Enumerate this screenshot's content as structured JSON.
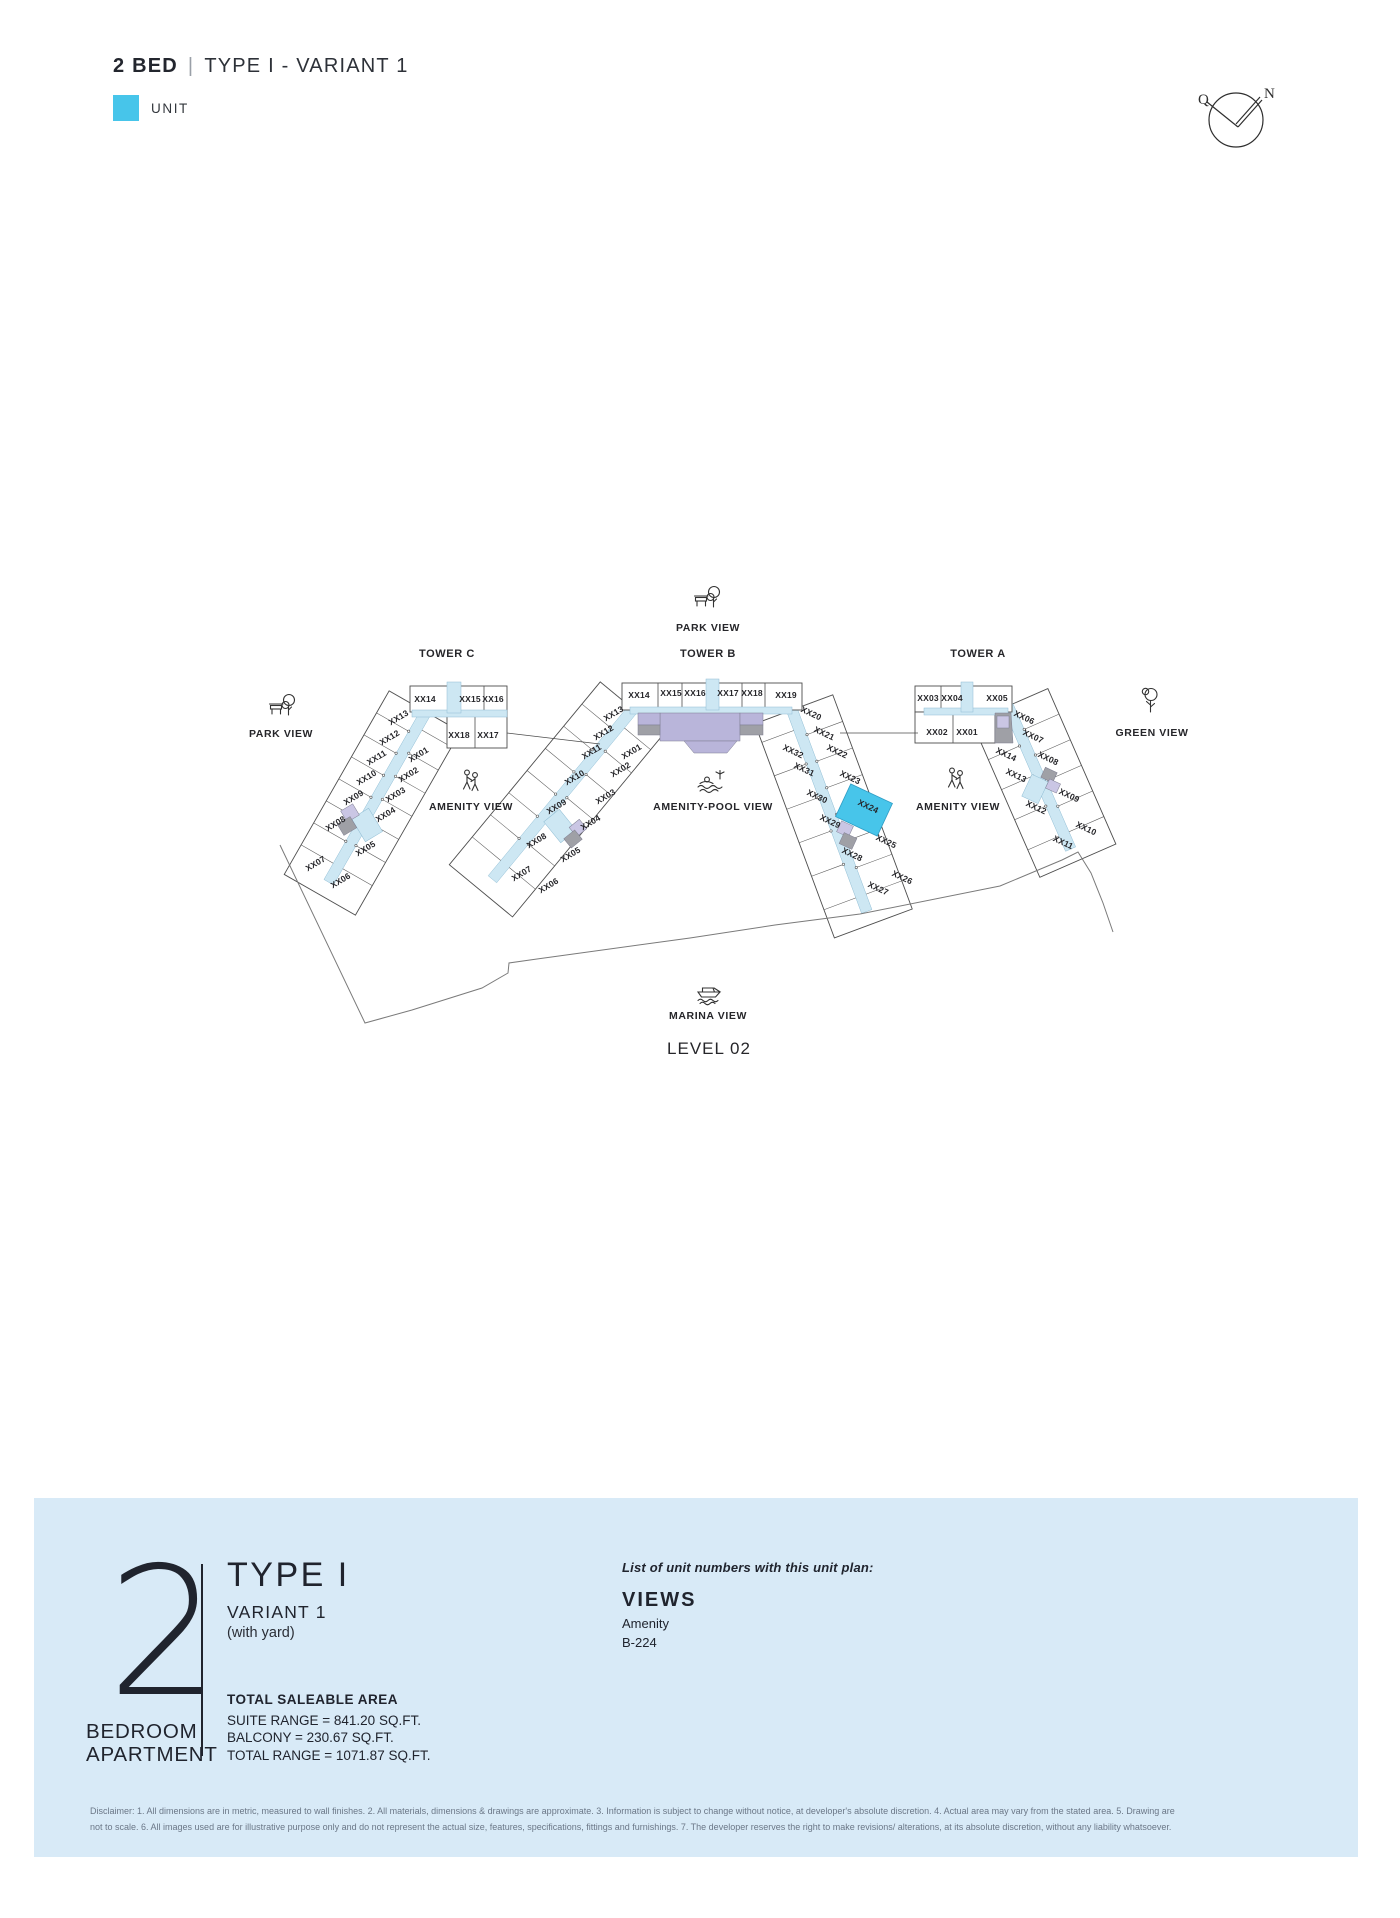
{
  "colors": {
    "accent_cyan": "#47C5EA",
    "panel_bg": "#D8EAF7",
    "corridor": "#cde7f3",
    "purple": "#b9b5da",
    "lavender": "#cac6e4",
    "gray": "#9fa0a6",
    "ink": "#20242e",
    "outline": "#4d4d4d",
    "boundary": "#7a7a7a"
  },
  "header": {
    "title_bold": "2 BED",
    "separator": "|",
    "title_rest": "TYPE I - VARIANT 1",
    "legend_label": "UNIT"
  },
  "compass": {
    "left_letter": "Q",
    "right_letter": "N"
  },
  "plan": {
    "level_label": "LEVEL 02",
    "level_pos": {
      "x": 709,
      "y": 1054
    },
    "towers": [
      {
        "name": "TOWER C",
        "x": 447,
        "y": 657
      },
      {
        "name": "TOWER B",
        "x": 708,
        "y": 657
      },
      {
        "name": "TOWER A",
        "x": 978,
        "y": 657
      }
    ],
    "views": [
      {
        "name": "park-view-top",
        "label": "PARK VIEW",
        "icon": "park",
        "lx": 708,
        "ly": 631,
        "ix": 708,
        "iy": 598
      },
      {
        "name": "park-view-left",
        "label": "PARK VIEW",
        "icon": "park",
        "lx": 281,
        "ly": 737,
        "ix": 283,
        "iy": 706
      },
      {
        "name": "amenity-view-left",
        "label": "AMENITY VIEW",
        "icon": "people",
        "lx": 471,
        "ly": 810,
        "ix": 471,
        "iy": 781
      },
      {
        "name": "amenity-pool-view",
        "label": "AMENITY-POOL VIEW",
        "icon": "pool",
        "lx": 713,
        "ly": 810,
        "ix": 711,
        "iy": 783
      },
      {
        "name": "amenity-view-right",
        "label": "AMENITY VIEW",
        "icon": "people",
        "lx": 958,
        "ly": 810,
        "ix": 956,
        "iy": 779
      },
      {
        "name": "green-view",
        "label": "GREEN VIEW",
        "icon": "tree",
        "lx": 1152,
        "ly": 736,
        "ix": 1150,
        "iy": 700
      },
      {
        "name": "marina-view",
        "label": "MARINA VIEW",
        "icon": "boat",
        "lx": 708,
        "ly": 1019,
        "ix": 708,
        "iy": 991
      }
    ],
    "wings": [
      {
        "id": "tower-c-wing",
        "p1": [
          426,
          712
        ],
        "p2": [
          338,
          866
        ],
        "cap": 34,
        "outer_side": "right",
        "outer_w": 37,
        "inner_w": 34,
        "n_outer": 7,
        "n_inner": 6,
        "inner_t0": 0.1,
        "ch": 5.5
      },
      {
        "id": "tower-b-left-wing",
        "p1": [
          633,
          709
        ],
        "p2": [
          505,
          864
        ],
        "cap": 36,
        "outer_side": "right",
        "outer_w": 37,
        "inner_w": 34,
        "n_outer": 7,
        "n_inner": 6,
        "inner_t0": 0.1,
        "ch": 5.5
      },
      {
        "id": "tower-b-right-wing",
        "p1": [
          792,
          710
        ],
        "p2": [
          861,
          896
        ],
        "cap": 30,
        "outer_side": "left",
        "outer_w": 38,
        "inner_w": 34,
        "n_outer": 7,
        "n_inner": 5,
        "inner_t0": 0.1,
        "ch": 5.5
      },
      {
        "id": "tower-a-wing",
        "p1": [
          1008,
          706
        ],
        "p2": [
          1064,
          834
        ],
        "cap": 30,
        "outer_side": "left",
        "outer_w": 38,
        "inner_w": 34,
        "n_outer": 5,
        "n_inner": 4,
        "inner_t0": 0.06,
        "ch": 5.5
      }
    ],
    "shapes": [
      {
        "k": "rect",
        "x": 410,
        "y": 686,
        "w": 97,
        "h": 26,
        "f": "#ffffff",
        "s": 1
      },
      {
        "k": "rect",
        "x": 447,
        "y": 712,
        "w": 60,
        "h": 36,
        "f": "#ffffff",
        "s": 1
      },
      {
        "k": "line",
        "x1": 484,
        "y1": 686,
        "x2": 484,
        "y2": 712
      },
      {
        "k": "line",
        "x1": 475,
        "y1": 712,
        "x2": 475,
        "y2": 748
      },
      {
        "k": "rect",
        "x": 412,
        "y": 710,
        "w": 95,
        "h": 7,
        "f": "corridor"
      },
      {
        "k": "rect",
        "x": 447,
        "y": 682,
        "w": 14,
        "h": 31,
        "f": "corridor"
      },
      {
        "k": "rect",
        "x": 622,
        "y": 683,
        "w": 180,
        "h": 27,
        "f": "#ffffff",
        "s": 1
      },
      {
        "k": "line",
        "x1": 658,
        "y1": 683,
        "x2": 658,
        "y2": 710
      },
      {
        "k": "line",
        "x1": 682,
        "y1": 683,
        "x2": 682,
        "y2": 710
      },
      {
        "k": "line",
        "x1": 742,
        "y1": 683,
        "x2": 742,
        "y2": 710
      },
      {
        "k": "line",
        "x1": 765,
        "y1": 683,
        "x2": 765,
        "y2": 710
      },
      {
        "k": "rect",
        "x": 630,
        "y": 707,
        "w": 162,
        "h": 7,
        "f": "corridor"
      },
      {
        "k": "rect",
        "x": 706,
        "y": 679,
        "w": 13,
        "h": 31,
        "f": "corridor"
      },
      {
        "k": "rect",
        "x": 660,
        "y": 713,
        "w": 80,
        "h": 28,
        "f": "purple"
      },
      {
        "k": "poly",
        "pts": "684,741 737,741 727,753 694,753",
        "f": "purple"
      },
      {
        "k": "rect",
        "x": 638,
        "y": 713,
        "w": 22,
        "h": 12,
        "f": "purple"
      },
      {
        "k": "rect",
        "x": 638,
        "y": 725,
        "w": 22,
        "h": 10,
        "f": "gray"
      },
      {
        "k": "rect",
        "x": 740,
        "y": 713,
        "w": 23,
        "h": 12,
        "f": "purple"
      },
      {
        "k": "rect",
        "x": 740,
        "y": 725,
        "w": 23,
        "h": 10,
        "f": "gray"
      },
      {
        "k": "rect",
        "x": 915,
        "y": 686,
        "w": 97,
        "h": 26,
        "f": "#ffffff",
        "s": 1
      },
      {
        "k": "rect",
        "x": 915,
        "y": 712,
        "w": 80,
        "h": 31,
        "f": "#ffffff",
        "s": 1
      },
      {
        "k": "line",
        "x1": 941,
        "y1": 686,
        "x2": 941,
        "y2": 712
      },
      {
        "k": "line",
        "x1": 953,
        "y1": 712,
        "x2": 953,
        "y2": 743
      },
      {
        "k": "rect",
        "x": 924,
        "y": 708,
        "w": 84,
        "h": 7,
        "f": "corridor"
      },
      {
        "k": "rect",
        "x": 961,
        "y": 682,
        "w": 12,
        "h": 30,
        "f": "corridor"
      },
      {
        "k": "poly",
        "pts": "995,713 1011,713 1013,743 995,743",
        "f": "gray"
      },
      {
        "k": "rect",
        "x": 997,
        "y": 716,
        "w": 12,
        "h": 12,
        "f": "lav"
      },
      {
        "k": "line",
        "x1": 507,
        "y1": 733,
        "x2": 600,
        "y2": 744
      },
      {
        "k": "line",
        "x1": 840,
        "y1": 733,
        "x2": 918,
        "y2": 733
      },
      {
        "k": "rrect",
        "cx": 367,
        "cy": 825,
        "w": 20,
        "h": 27,
        "rot": -31,
        "f": "corridor"
      },
      {
        "k": "rrect",
        "cx": 350,
        "cy": 813,
        "w": 14,
        "h": 13,
        "rot": -31,
        "f": "lav"
      },
      {
        "k": "rrect",
        "cx": 347,
        "cy": 826,
        "w": 15,
        "h": 13,
        "rot": -31,
        "f": "gray"
      },
      {
        "k": "rrect",
        "cx": 560,
        "cy": 826,
        "w": 20,
        "h": 27,
        "rot": -39,
        "f": "corridor"
      },
      {
        "k": "rrect",
        "cx": 578,
        "cy": 828,
        "w": 13,
        "h": 12,
        "rot": -39,
        "f": "lav"
      },
      {
        "k": "rrect",
        "cx": 573,
        "cy": 839,
        "w": 14,
        "h": 12,
        "rot": -39,
        "f": "gray"
      },
      {
        "k": "rrect",
        "cx": 845,
        "cy": 829,
        "w": 13,
        "h": 12,
        "rot": 25,
        "f": "lav"
      },
      {
        "k": "rrect",
        "cx": 848,
        "cy": 841,
        "w": 14,
        "h": 12,
        "rot": 25,
        "f": "gray"
      },
      {
        "k": "rrect",
        "cx": 1035,
        "cy": 789,
        "w": 18,
        "h": 24,
        "rot": 25,
        "f": "corridor"
      },
      {
        "k": "rrect",
        "cx": 1049,
        "cy": 775,
        "w": 13,
        "h": 11,
        "rot": 25,
        "f": "gray"
      },
      {
        "k": "rrect",
        "cx": 1053,
        "cy": 786,
        "w": 12,
        "h": 10,
        "rot": 25,
        "f": "lav"
      }
    ],
    "highlight_unit": {
      "label": "XX24",
      "cx": 864,
      "cy": 810,
      "w": 46,
      "h": 36,
      "rot": 25
    },
    "boundary": "M 280,845 L 365,1023 L 412,1010 L 482,988 L 508,973 L 509,963 L 537,959 L 690,938 L 775,925 L 860,914 L 1000,886 L 1062,860 L 1078,852 L 1091,873 L 1103,903 L 1113,932",
    "unit_labels": [
      {
        "tw": "c",
        "t": "XX14",
        "x": 425,
        "y": 702,
        "r": 0
      },
      {
        "tw": "c",
        "t": "XX15",
        "x": 470,
        "y": 702,
        "r": 0
      },
      {
        "tw": "c",
        "t": "XX16",
        "x": 493,
        "y": 702,
        "r": 0
      },
      {
        "tw": "c",
        "t": "XX18",
        "x": 459,
        "y": 738,
        "r": 0
      },
      {
        "tw": "c",
        "t": "XX17",
        "x": 488,
        "y": 738,
        "r": 0
      },
      {
        "tw": "c",
        "t": "XX13",
        "x": 400,
        "y": 720,
        "r": -31
      },
      {
        "tw": "c",
        "t": "XX12",
        "x": 391,
        "y": 740,
        "r": -31
      },
      {
        "tw": "c",
        "t": "XX11",
        "x": 378,
        "y": 760,
        "r": -31
      },
      {
        "tw": "c",
        "t": "XX10",
        "x": 368,
        "y": 780,
        "r": -31
      },
      {
        "tw": "c",
        "t": "XX09",
        "x": 355,
        "y": 800,
        "r": -31
      },
      {
        "tw": "c",
        "t": "XX08",
        "x": 337,
        "y": 826,
        "r": -31
      },
      {
        "tw": "c",
        "t": "XX07",
        "x": 317,
        "y": 866,
        "r": -31
      },
      {
        "tw": "c",
        "t": "XX06",
        "x": 342,
        "y": 883,
        "r": -31
      },
      {
        "tw": "c",
        "t": "XX01",
        "x": 420,
        "y": 757,
        "r": -31
      },
      {
        "tw": "c",
        "t": "XX02",
        "x": 410,
        "y": 777,
        "r": -31
      },
      {
        "tw": "c",
        "t": "XX03",
        "x": 397,
        "y": 797,
        "r": -31
      },
      {
        "tw": "c",
        "t": "XX04",
        "x": 387,
        "y": 817,
        "r": -31
      },
      {
        "tw": "c",
        "t": "XX05",
        "x": 367,
        "y": 851,
        "r": -31
      },
      {
        "tw": "b",
        "t": "XX14",
        "x": 639,
        "y": 698,
        "r": 0
      },
      {
        "tw": "b",
        "t": "XX15",
        "x": 671,
        "y": 696,
        "r": 0
      },
      {
        "tw": "b",
        "t": "XX16",
        "x": 695,
        "y": 696,
        "r": 0
      },
      {
        "tw": "b",
        "t": "XX17",
        "x": 728,
        "y": 696,
        "r": 0
      },
      {
        "tw": "b",
        "t": "XX18",
        "x": 752,
        "y": 696,
        "r": 0
      },
      {
        "tw": "b",
        "t": "XX19",
        "x": 786,
        "y": 698,
        "r": 0
      },
      {
        "tw": "b",
        "t": "XX13",
        "x": 615,
        "y": 716,
        "r": -31
      },
      {
        "tw": "b",
        "t": "XX12",
        "x": 605,
        "y": 735,
        "r": -31
      },
      {
        "tw": "b",
        "t": "XX11",
        "x": 593,
        "y": 754,
        "r": -31
      },
      {
        "tw": "b",
        "t": "XX10",
        "x": 576,
        "y": 780,
        "r": -31
      },
      {
        "tw": "b",
        "t": "XX09",
        "x": 558,
        "y": 809,
        "r": -31
      },
      {
        "tw": "b",
        "t": "XX08",
        "x": 538,
        "y": 843,
        "r": -31
      },
      {
        "tw": "b",
        "t": "XX07",
        "x": 523,
        "y": 876,
        "r": -31
      },
      {
        "tw": "b",
        "t": "XX01",
        "x": 633,
        "y": 754,
        "r": -31
      },
      {
        "tw": "b",
        "t": "XX02",
        "x": 622,
        "y": 772,
        "r": -31
      },
      {
        "tw": "b",
        "t": "XX03",
        "x": 607,
        "y": 799,
        "r": -31
      },
      {
        "tw": "b",
        "t": "XX04",
        "x": 592,
        "y": 825,
        "r": -31
      },
      {
        "tw": "b",
        "t": "XX05",
        "x": 572,
        "y": 857,
        "r": -31
      },
      {
        "tw": "b",
        "t": "XX06",
        "x": 550,
        "y": 888,
        "r": -31
      },
      {
        "tw": "b",
        "t": "XX20",
        "x": 810,
        "y": 716,
        "r": 25
      },
      {
        "tw": "b",
        "t": "XX21",
        "x": 823,
        "y": 736,
        "r": 25
      },
      {
        "tw": "b",
        "t": "XX22",
        "x": 836,
        "y": 754,
        "r": 25
      },
      {
        "tw": "b",
        "t": "XX23",
        "x": 849,
        "y": 780,
        "r": 25
      },
      {
        "tw": "b",
        "t": "XX24",
        "x": 867,
        "y": 809,
        "r": 25
      },
      {
        "tw": "b",
        "t": "XX25",
        "x": 885,
        "y": 844,
        "r": 25
      },
      {
        "tw": "b",
        "t": "XX26",
        "x": 901,
        "y": 880,
        "r": 25
      },
      {
        "tw": "b",
        "t": "XX27",
        "x": 877,
        "y": 891,
        "r": 25
      },
      {
        "tw": "b",
        "t": "XX32",
        "x": 792,
        "y": 754,
        "r": 25
      },
      {
        "tw": "b",
        "t": "XX31",
        "x": 803,
        "y": 772,
        "r": 25
      },
      {
        "tw": "b",
        "t": "XX30",
        "x": 816,
        "y": 799,
        "r": 25
      },
      {
        "tw": "b",
        "t": "XX29",
        "x": 829,
        "y": 824,
        "r": 25
      },
      {
        "tw": "b",
        "t": "XX28",
        "x": 851,
        "y": 857,
        "r": 25
      },
      {
        "tw": "a",
        "t": "XX03",
        "x": 928,
        "y": 701,
        "r": 0
      },
      {
        "tw": "a",
        "t": "XX04",
        "x": 952,
        "y": 701,
        "r": 0
      },
      {
        "tw": "a",
        "t": "XX05",
        "x": 997,
        "y": 701,
        "r": 0
      },
      {
        "tw": "a",
        "t": "XX02",
        "x": 937,
        "y": 735,
        "r": 0
      },
      {
        "tw": "a",
        "t": "XX01",
        "x": 967,
        "y": 735,
        "r": 0
      },
      {
        "tw": "a",
        "t": "XX06",
        "x": 1023,
        "y": 720,
        "r": 25
      },
      {
        "tw": "a",
        "t": "XX07",
        "x": 1032,
        "y": 739,
        "r": 25
      },
      {
        "tw": "a",
        "t": "XX08",
        "x": 1047,
        "y": 761,
        "r": 25
      },
      {
        "tw": "a",
        "t": "XX09",
        "x": 1068,
        "y": 798,
        "r": 25
      },
      {
        "tw": "a",
        "t": "XX10",
        "x": 1085,
        "y": 831,
        "r": 25
      },
      {
        "tw": "a",
        "t": "XX14",
        "x": 1005,
        "y": 757,
        "r": 25
      },
      {
        "tw": "a",
        "t": "XX13",
        "x": 1015,
        "y": 778,
        "r": 25
      },
      {
        "tw": "a",
        "t": "XX12",
        "x": 1035,
        "y": 810,
        "r": 25
      },
      {
        "tw": "a",
        "t": "XX11",
        "x": 1062,
        "y": 845,
        "r": 25
      }
    ]
  },
  "panel": {
    "big_number": "2",
    "big_caption_line1": "BEDROOM",
    "big_caption_line2": "APARTMENT",
    "type_title": "TYPE I",
    "variant": "VARIANT 1",
    "note": "(with yard)",
    "area_heading": "TOTAL SALEABLE AREA",
    "area_lines": [
      "SUITE RANGE = 841.20  SQ.FT.",
      "BALCONY = 230.67  SQ.FT.",
      "TOTAL RANGE = 1071.87 SQ.FT."
    ],
    "list_intro": "List of unit numbers with this unit plan:",
    "views_heading": "VIEWS",
    "views_list": [
      "Amenity",
      "B-224"
    ]
  },
  "disclaimer_line1": "Disclaimer: 1. All dimensions are in metric, measured to wall finishes. 2. All materials, dimensions & drawings are approximate. 3. Information is subject to change without notice, at developer's absolute discretion. 4. Actual area may vary from the stated area. 5. Drawing are",
  "disclaimer_line2": "not to scale. 6. All images used are for illustrative purpose only and do not represent the actual size, features, specifications, fittings and furnishings. 7. The developer reserves the right to make revisions/ alterations, at its absolute discretion, without any liability whatsoever."
}
